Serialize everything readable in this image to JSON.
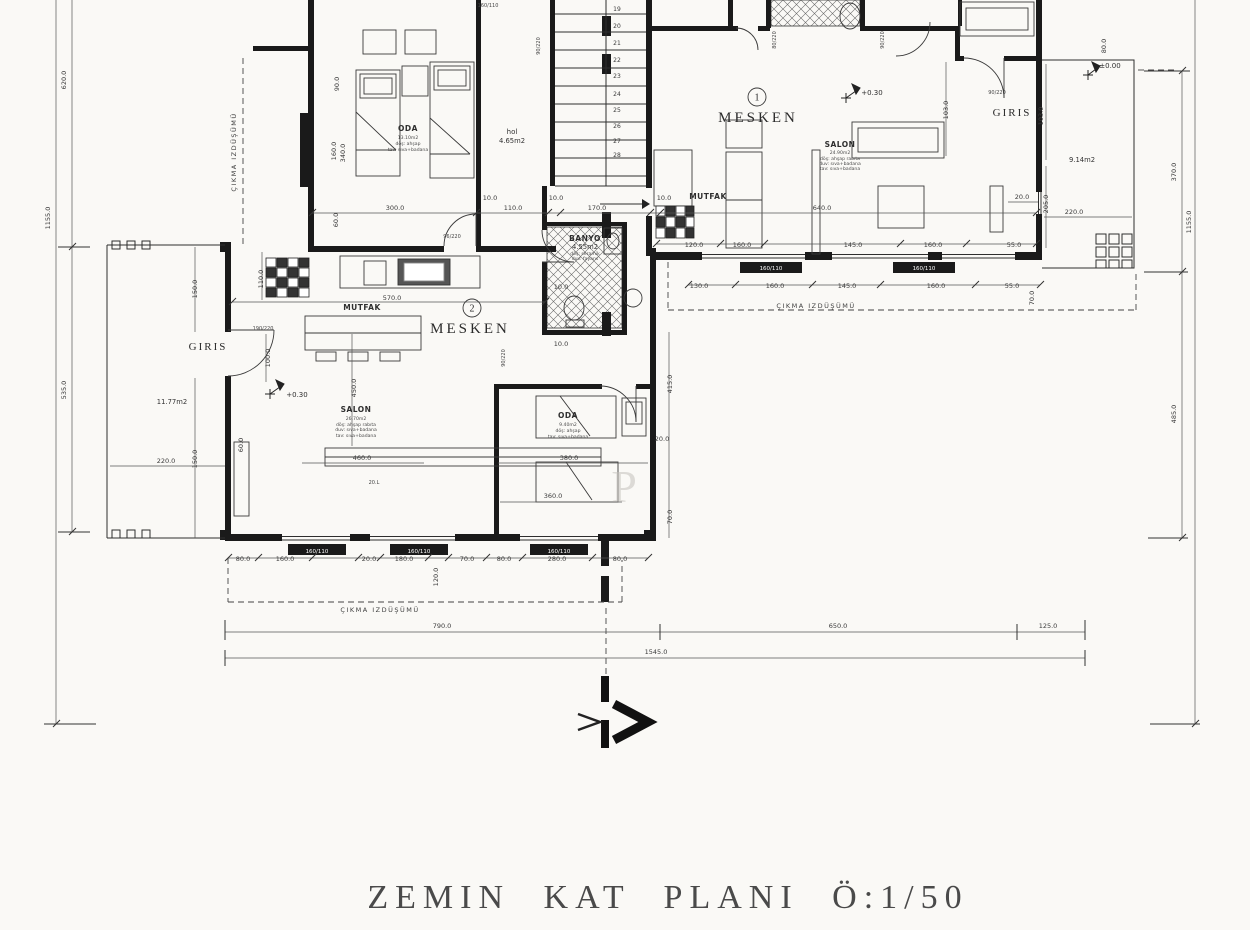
{
  "title": "ZEMIN KAT PLANI Ö:1/50",
  "colors": {
    "paper": "#faf9f6",
    "ink": "#2e2e2e",
    "wall": "#1a1a1a",
    "dim_text": "#3a3a3a",
    "watermark": "#c5c2bc"
  },
  "units": {
    "m1": {
      "no": "1",
      "name": "MESKEN",
      "elev": "+0.30"
    },
    "m2": {
      "no": "2",
      "name": "MESKEN",
      "elev": "+0.30"
    }
  },
  "rooms": {
    "oda1": "ODA",
    "oda2": "ODA",
    "salon1": "SALON",
    "salon2": "SALON",
    "mutfak1": "MUTFAK",
    "mutfak2": "MUTFAK",
    "banyo": "BANYO",
    "banyo_area": "4.55m2",
    "hol": "hol",
    "hol_area": "4.65m2",
    "giris_left": "GIRIS",
    "giris_left_area": "11.77m2",
    "giris_right": "GIRIS",
    "giris_right_area": "9.14m2",
    "porch_elev": "±0.00"
  },
  "sub_lines": [
    {
      "t": "13.10m2",
      "x": 408,
      "y": 139
    },
    {
      "t": "döş: ahşap",
      "x": 408,
      "y": 145
    },
    {
      "t": "tav: sıva+badana",
      "x": 408,
      "y": 151
    },
    {
      "t": "24.90m2",
      "x": 840,
      "y": 154
    },
    {
      "t": "döş: ahşap rabıta",
      "x": 840,
      "y": 160
    },
    {
      "t": "duv: sıva+badana",
      "x": 840,
      "y": 165
    },
    {
      "t": "tav: sıva+badana",
      "x": 840,
      "y": 170
    },
    {
      "t": "26.70m2",
      "x": 356,
      "y": 420
    },
    {
      "t": "döş: ahşap rabıta",
      "x": 356,
      "y": 426
    },
    {
      "t": "duv: sıva+badana",
      "x": 356,
      "y": 431
    },
    {
      "t": "tav: sıva+badana",
      "x": 356,
      "y": 437
    },
    {
      "t": "9.40m2",
      "x": 568,
      "y": 426
    },
    {
      "t": "döş: ahşap",
      "x": 568,
      "y": 432
    },
    {
      "t": "tav: sıva+badana",
      "x": 568,
      "y": 438
    },
    {
      "t": "döş: seramik",
      "x": 585,
      "y": 255
    },
    {
      "t": "duv: fayans",
      "x": 585,
      "y": 260
    }
  ],
  "dims": [
    {
      "t": "300.0",
      "x": 395,
      "y": 210
    },
    {
      "t": "110.0",
      "x": 513,
      "y": 210
    },
    {
      "t": "170.0",
      "x": 597,
      "y": 210
    },
    {
      "t": "640.0",
      "x": 822,
      "y": 210
    },
    {
      "t": "10.0",
      "x": 490,
      "y": 200
    },
    {
      "t": "10.0",
      "x": 556,
      "y": 200
    },
    {
      "t": "10.0",
      "x": 664,
      "y": 200
    },
    {
      "t": "10.0",
      "x": 561,
      "y": 289
    },
    {
      "t": "10.0",
      "x": 561,
      "y": 346
    },
    {
      "t": "120.0",
      "x": 694,
      "y": 247
    },
    {
      "t": "160.0",
      "x": 742,
      "y": 247
    },
    {
      "t": "145.0",
      "x": 853,
      "y": 247
    },
    {
      "t": "160.0",
      "x": 933,
      "y": 247
    },
    {
      "t": "55.0",
      "x": 1014,
      "y": 247
    },
    {
      "t": "130.0",
      "x": 699,
      "y": 288
    },
    {
      "t": "160.0",
      "x": 775,
      "y": 288
    },
    {
      "t": "145.0",
      "x": 847,
      "y": 288
    },
    {
      "t": "160.0",
      "x": 936,
      "y": 288
    },
    {
      "t": "55.0",
      "x": 1012,
      "y": 288
    },
    {
      "t": "70.0",
      "x": 1034,
      "y": 298,
      "r": 270
    },
    {
      "t": "80.0",
      "x": 243,
      "y": 561
    },
    {
      "t": "160.0",
      "x": 285,
      "y": 561
    },
    {
      "t": "20.0",
      "x": 369,
      "y": 561
    },
    {
      "t": "180.0",
      "x": 404,
      "y": 561
    },
    {
      "t": "70.0",
      "x": 467,
      "y": 561
    },
    {
      "t": "80.0",
      "x": 504,
      "y": 561
    },
    {
      "t": "280.0",
      "x": 557,
      "y": 561
    },
    {
      "t": "80.0",
      "x": 620,
      "y": 561
    },
    {
      "t": "120.0",
      "x": 438,
      "y": 577,
      "r": 270
    },
    {
      "t": "790.0",
      "x": 442,
      "y": 628
    },
    {
      "t": "650.0",
      "x": 838,
      "y": 628
    },
    {
      "t": "125.0",
      "x": 1048,
      "y": 628
    },
    {
      "t": "1545.0",
      "x": 656,
      "y": 654
    },
    {
      "t": "620.0",
      "x": 66,
      "y": 80,
      "r": 270
    },
    {
      "t": "1155.0",
      "x": 50,
      "y": 218,
      "r": 270
    },
    {
      "t": "535.0",
      "x": 66,
      "y": 390,
      "r": 270
    },
    {
      "t": "80.0",
      "x": 1106,
      "y": 46,
      "r": 270
    },
    {
      "t": "370.0",
      "x": 1176,
      "y": 172,
      "r": 270
    },
    {
      "t": "1155.0",
      "x": 1191,
      "y": 222,
      "r": 270
    },
    {
      "t": "485.0",
      "x": 1176,
      "y": 414,
      "r": 270
    },
    {
      "t": "103.0",
      "x": 948,
      "y": 110,
      "r": 270
    },
    {
      "t": "103.0",
      "x": 1043,
      "y": 116,
      "r": 270
    },
    {
      "t": "205.0",
      "x": 1048,
      "y": 204,
      "r": 270
    },
    {
      "t": "20.0",
      "x": 1022,
      "y": 199
    },
    {
      "t": "220.0",
      "x": 1074,
      "y": 214
    },
    {
      "t": "150.0",
      "x": 197,
      "y": 289,
      "r": 270
    },
    {
      "t": "150.0",
      "x": 197,
      "y": 459,
      "r": 270
    },
    {
      "t": "100.0",
      "x": 270,
      "y": 358,
      "r": 270
    },
    {
      "t": "220.0",
      "x": 166,
      "y": 463
    },
    {
      "t": "570.0",
      "x": 392,
      "y": 300
    },
    {
      "t": "110.0",
      "x": 263,
      "y": 279,
      "r": 270
    },
    {
      "t": "450.0",
      "x": 356,
      "y": 388,
      "r": 270
    },
    {
      "t": "460.0",
      "x": 362,
      "y": 460
    },
    {
      "t": "60.0",
      "x": 243,
      "y": 445,
      "r": 270
    },
    {
      "t": "380.0",
      "x": 569,
      "y": 460
    },
    {
      "t": "360.0",
      "x": 553,
      "y": 498
    },
    {
      "t": "415.0",
      "x": 672,
      "y": 384,
      "r": 270
    },
    {
      "t": "20.0",
      "x": 662,
      "y": 441
    },
    {
      "t": "70.0",
      "x": 672,
      "y": 517,
      "r": 270
    },
    {
      "t": "90.0",
      "x": 339,
      "y": 84,
      "r": 270
    },
    {
      "t": "160.0",
      "x": 336,
      "y": 151,
      "r": 270
    },
    {
      "t": "340.0",
      "x": 345,
      "y": 153,
      "r": 270
    },
    {
      "t": "60.0",
      "x": 338,
      "y": 220,
      "r": 270
    }
  ],
  "tags": [
    {
      "t": "96/220",
      "x": 452,
      "y": 238
    },
    {
      "t": "190/220",
      "x": 263,
      "y": 330
    },
    {
      "t": "90/220",
      "x": 505,
      "y": 358,
      "r": 270
    },
    {
      "t": "90/220",
      "x": 540,
      "y": 46,
      "r": 270
    },
    {
      "t": "80/220",
      "x": 776,
      "y": 40,
      "r": 270
    },
    {
      "t": "90/220",
      "x": 884,
      "y": 40,
      "r": 270
    },
    {
      "t": "90/220",
      "x": 997,
      "y": 94
    },
    {
      "t": "160/110",
      "x": 488,
      "y": 7
    },
    {
      "t": "20.L",
      "x": 374,
      "y": 484
    }
  ],
  "window_tags": [
    {
      "t": "160/110",
      "x": 771,
      "y": 270
    },
    {
      "t": "160/110",
      "x": 924,
      "y": 270
    },
    {
      "t": "160/110",
      "x": 317,
      "y": 553
    },
    {
      "t": "160/110",
      "x": 419,
      "y": 553
    },
    {
      "t": "160/110",
      "x": 559,
      "y": 553
    }
  ],
  "stair_numbers": [
    {
      "t": "19",
      "x": 617,
      "y": 11
    },
    {
      "t": "20",
      "x": 617,
      "y": 28
    },
    {
      "t": "21",
      "x": 617,
      "y": 45
    },
    {
      "t": "22",
      "x": 617,
      "y": 62
    },
    {
      "t": "23",
      "x": 617,
      "y": 78
    },
    {
      "t": "24",
      "x": 617,
      "y": 96
    },
    {
      "t": "25",
      "x": 617,
      "y": 112
    },
    {
      "t": "26",
      "x": 617,
      "y": 128
    },
    {
      "t": "27",
      "x": 617,
      "y": 143
    },
    {
      "t": "28",
      "x": 617,
      "y": 157
    }
  ],
  "annotations": [
    {
      "t": "ÇIKMA IZDÜŞÜMÜ",
      "x": 236,
      "y": 152,
      "r": 270
    },
    {
      "t": "ÇIKMA IZDÜŞÜMÜ",
      "x": 816,
      "y": 308
    },
    {
      "t": "ÇIKMA IZDÜŞÜMÜ",
      "x": 380,
      "y": 612
    }
  ],
  "watermark": {
    "t": "P"
  }
}
